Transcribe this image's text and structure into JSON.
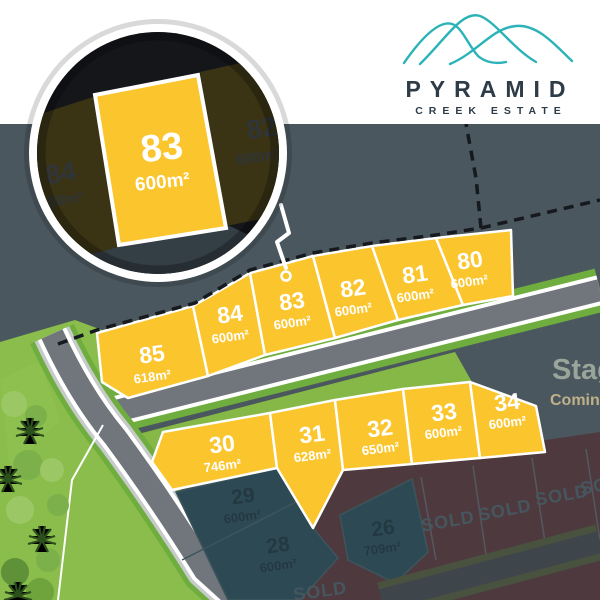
{
  "brand": {
    "name": "PYRAMID",
    "tagline": "CREEK ESTATE",
    "logo_icon": "three overlapping teal mountain curves"
  },
  "stage_teaser": {
    "title": "Stage",
    "subtitle": "Coming"
  },
  "magnifier": {
    "focus_lot": {
      "number": "83",
      "area": "600m²"
    },
    "left_lot": {
      "number": "84",
      "area": "600m²"
    },
    "right_lot": {
      "number": "82",
      "area": "600m²"
    }
  },
  "lots": {
    "top_row": [
      {
        "number": "85",
        "area": "618m²"
      },
      {
        "number": "84",
        "area": "600m²"
      },
      {
        "number": "83",
        "area": "600m²"
      },
      {
        "number": "82",
        "area": "600m²"
      },
      {
        "number": "81",
        "area": "600m²"
      },
      {
        "number": "80",
        "area": "600m²"
      }
    ],
    "middle_row": [
      {
        "number": "30",
        "area": "746m²"
      },
      {
        "number": "31",
        "area": "628m²"
      },
      {
        "number": "32",
        "area": "650m²"
      },
      {
        "number": "33",
        "area": "600m²"
      },
      {
        "number": "34",
        "area": "600m²"
      }
    ],
    "future_row": [
      {
        "number": "29",
        "area": "600m²"
      },
      {
        "number": "28",
        "area": "600m²"
      },
      {
        "number": "26",
        "area": "709m²"
      }
    ],
    "sold": [
      {
        "label": "SOLD"
      },
      {
        "label": "SOLD"
      },
      {
        "label": "SOLD"
      },
      {
        "label": "SOLD"
      },
      {
        "label": "SOLD"
      }
    ]
  },
  "colors": {
    "available_lot": "#FBC52D",
    "future_lot": "#2D4A54",
    "sold_lot": "#4E3A3E",
    "stage_background": "#4A575E",
    "grass": "#8ABD4B",
    "road": "#70767B",
    "brand_teal": "#2BB3B8",
    "brand_navy": "#2E3C48"
  }
}
